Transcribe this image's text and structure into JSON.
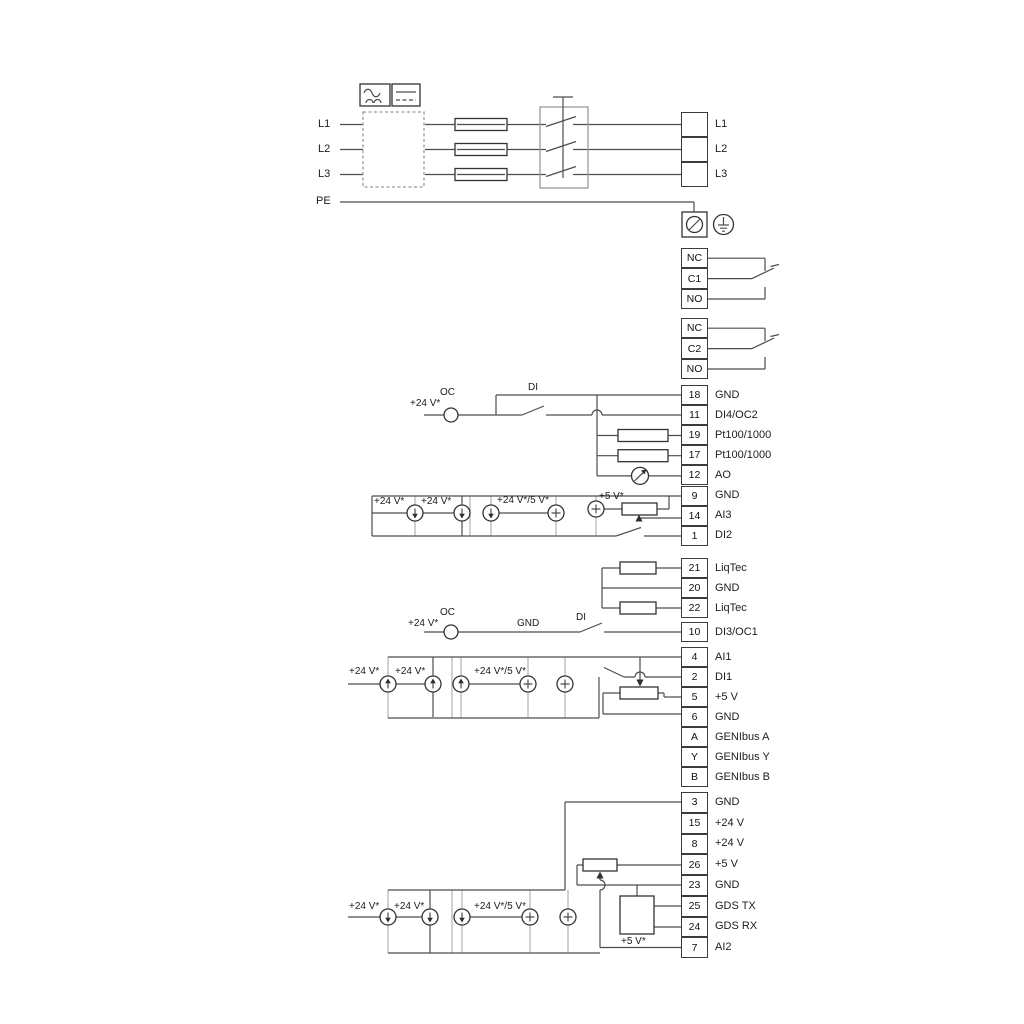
{
  "power": {
    "inputs": [
      "L1",
      "L2",
      "L3"
    ],
    "pe": "PE"
  },
  "annotations": {
    "v24": "+24 V*",
    "v24_5": "+24 V*/5 V*",
    "v5": "+5 V*",
    "oc": "OC",
    "di": "DI",
    "gnd": "GND"
  },
  "terminal_strips": [
    {
      "id": "s_power",
      "name": "mains-output-terminals",
      "cells": [
        {
          "num": "",
          "label": "L1"
        },
        {
          "num": "",
          "label": "L2"
        },
        {
          "num": "",
          "label": "L3"
        }
      ]
    },
    {
      "id": "s_r1",
      "name": "relay1-terminals",
      "cells": [
        {
          "num": "NC",
          "label": ""
        },
        {
          "num": "C1",
          "label": ""
        },
        {
          "num": "NO",
          "label": ""
        }
      ]
    },
    {
      "id": "s_r2",
      "name": "relay2-terminals",
      "cells": [
        {
          "num": "NC",
          "label": ""
        },
        {
          "num": "C2",
          "label": ""
        },
        {
          "num": "NO",
          "label": ""
        }
      ]
    },
    {
      "id": "s_main",
      "name": "io-terminals-upper",
      "cells": [
        {
          "num": "18",
          "label": "GND"
        },
        {
          "num": "11",
          "label": "DI4/OC2"
        },
        {
          "num": "19",
          "label": "Pt100/1000"
        },
        {
          "num": "17",
          "label": "Pt100/1000"
        },
        {
          "num": "12",
          "label": "AO"
        },
        {
          "num": "9",
          "label": "GND"
        },
        {
          "num": "14",
          "label": "AI3"
        },
        {
          "num": "1",
          "label": "DI2"
        }
      ]
    },
    {
      "id": "s_liq",
      "name": "liqtec-terminals",
      "cells": [
        {
          "num": "21",
          "label": "LiqTec"
        },
        {
          "num": "20",
          "label": "GND"
        },
        {
          "num": "22",
          "label": "LiqTec"
        }
      ]
    },
    {
      "id": "s_10",
      "name": "di3-terminal",
      "cells": [
        {
          "num": "10",
          "label": "DI3/OC1"
        }
      ]
    },
    {
      "id": "s_io",
      "name": "io-terminals-middle",
      "cells": [
        {
          "num": "4",
          "label": "AI1"
        },
        {
          "num": "2",
          "label": "DI1"
        },
        {
          "num": "5",
          "label": "+5 V"
        },
        {
          "num": "6",
          "label": "GND"
        },
        {
          "num": "A",
          "label": "GENIbus A"
        },
        {
          "num": "Y",
          "label": "GENIbus Y"
        },
        {
          "num": "B",
          "label": "GENIbus B"
        }
      ]
    },
    {
      "id": "s_bot",
      "name": "io-terminals-lower",
      "cells": [
        {
          "num": "3",
          "label": "GND"
        },
        {
          "num": "15",
          "label": "+24 V"
        },
        {
          "num": "8",
          "label": "+24 V"
        },
        {
          "num": "26",
          "label": "+5 V"
        },
        {
          "num": "23",
          "label": "GND"
        },
        {
          "num": "25",
          "label": "GDS TX"
        },
        {
          "num": "24",
          "label": "GDS RX"
        },
        {
          "num": "7",
          "label": "AI2"
        }
      ]
    }
  ]
}
